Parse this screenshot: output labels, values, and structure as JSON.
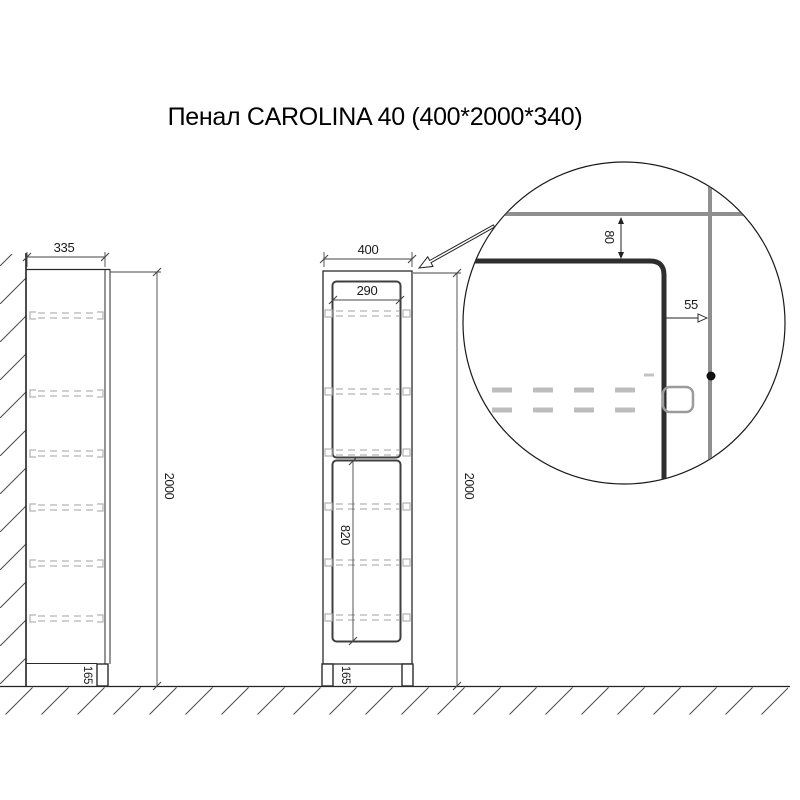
{
  "title": "Пенал CAROLINA 40 (400*2000*340)",
  "side_view": {
    "depth_dim": "335",
    "height_dim": "2000",
    "plinth_dim": "165"
  },
  "front_view": {
    "width_dim": "400",
    "door_width_dim": "290",
    "lower_door_height_dim": "820",
    "height_dim": "2000",
    "plinth_dim": "165"
  },
  "detail_view": {
    "top_offset_dim": "80",
    "side_offset_dim": "55"
  },
  "colors": {
    "background": "#ffffff",
    "outline": "#2b2b2b",
    "door_outline": "#3f3f3f",
    "shelf_dashed": "#b4b4b4",
    "detail_gray": "#8f8f8f",
    "text": "#1a1a1a"
  }
}
